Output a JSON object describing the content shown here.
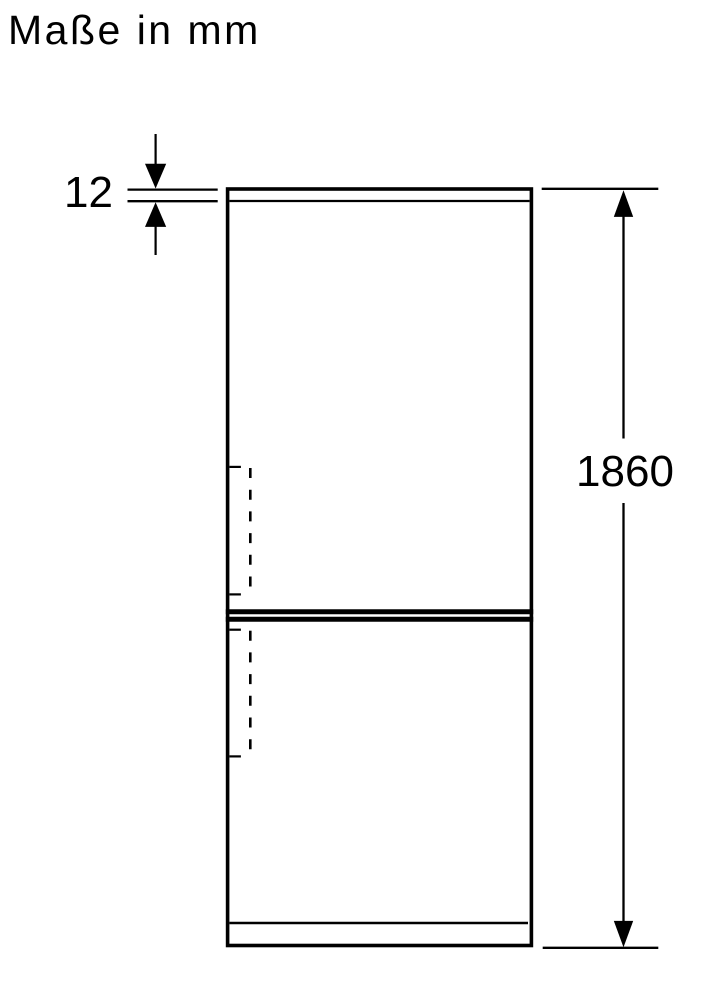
{
  "title": "Maße in mm",
  "drawing": {
    "subject": "fridge-freezer front outline dimension drawing",
    "unit": "mm",
    "dimensions": {
      "top_panel_thickness": {
        "value": "12"
      },
      "overall_height": {
        "value": "1860"
      }
    },
    "colors": {
      "line": "#000000",
      "background": "#ffffff"
    }
  }
}
